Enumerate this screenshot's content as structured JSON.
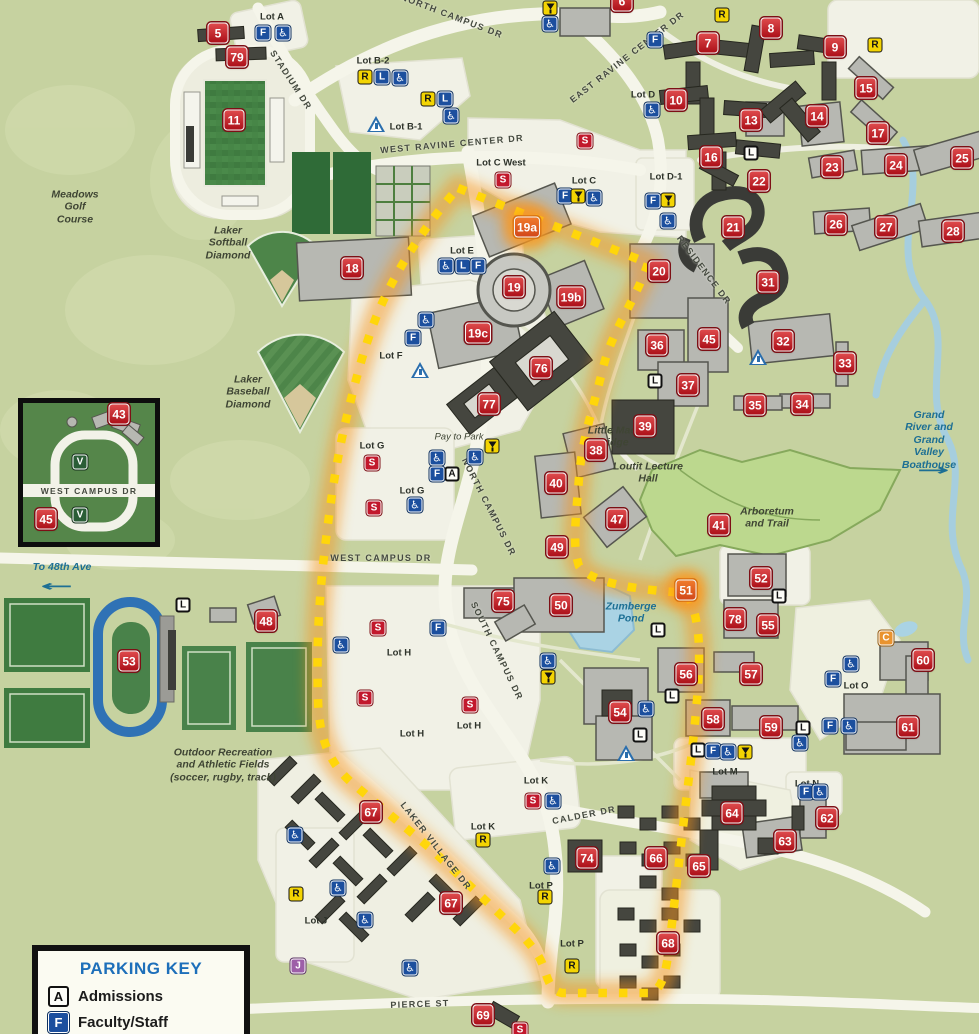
{
  "parking_key": {
    "title": "PARKING KEY",
    "entries": [
      {
        "code": "A",
        "label": "Admissions"
      },
      {
        "code": "F",
        "label": "Faculty/Staff"
      }
    ]
  },
  "colors": {
    "background": "#c6d2a0",
    "road": "#f5f5ea",
    "building_light": "#b7b8b2",
    "building_dark": "#45463f",
    "route_dots": "#ffd60a",
    "route_glow": "#f7941d",
    "badge_red": "#c01a22",
    "badge_blue": "#1c4f9e",
    "badge_yellow": "#f3d403",
    "water": "#a6cede",
    "field_green": "#47824a"
  },
  "road_labels": [
    {
      "text": "NORTH CAMPUS DR",
      "x": 452,
      "y": 16,
      "rot": 21,
      "size": 9
    },
    {
      "text": "EAST RAVINE CENTER DR",
      "x": 627,
      "y": 57,
      "rot": -38,
      "size": 9
    },
    {
      "text": "STADIUM DR",
      "x": 291,
      "y": 80,
      "rot": 57,
      "size": 9
    },
    {
      "text": "WEST RAVINE CENTER DR",
      "x": 452,
      "y": 144,
      "rot": -5,
      "size": 9
    },
    {
      "text": "RESIDENCE DR",
      "x": 704,
      "y": 270,
      "rot": 53,
      "size": 9
    },
    {
      "text": "NORTH CAMPUS DR",
      "x": 489,
      "y": 507,
      "rot": 63,
      "size": 9
    },
    {
      "text": "WEST CAMPUS DR",
      "x": 381,
      "y": 558,
      "rot": 0,
      "size": 9
    },
    {
      "text": "SOUTH CAMPUS DR",
      "x": 497,
      "y": 651,
      "rot": 64,
      "size": 9
    },
    {
      "text": "LAKER VILLAGE DR",
      "x": 436,
      "y": 846,
      "rot": 52,
      "size": 9
    },
    {
      "text": "CALDER  DR",
      "x": 584,
      "y": 815,
      "rot": -11,
      "size": 9
    },
    {
      "text": "PIERCE ST",
      "x": 420,
      "y": 1004,
      "rot": -2,
      "size": 9
    },
    {
      "text": "WEST CAMPUS DR",
      "x": 89,
      "y": 491,
      "rot": 0,
      "size": 8.5
    }
  ],
  "area_labels": [
    {
      "text": "Meadows\nGolf\nCourse",
      "x": 75,
      "y": 207,
      "style": "dark"
    },
    {
      "text": "Laker\nSoftball\nDiamond",
      "x": 228,
      "y": 243,
      "style": "dark"
    },
    {
      "text": "Laker\nBaseball\nDiamond",
      "x": 248,
      "y": 392,
      "style": "dark"
    },
    {
      "text": "Little Mac\nBridge",
      "x": 612,
      "y": 437,
      "style": "dark"
    },
    {
      "text": "Loutit Lecture\nHall",
      "x": 648,
      "y": 473,
      "style": "dark"
    },
    {
      "text": "Arboretum\nand Trail",
      "x": 767,
      "y": 518,
      "style": "dark"
    },
    {
      "text": "Zumberge\nPond",
      "x": 631,
      "y": 613,
      "style": "blue"
    },
    {
      "text": "Grand River and\nGrand Valley\nBoathouse",
      "x": 929,
      "y": 440,
      "style": "blue"
    },
    {
      "text": "To 48th Ave",
      "x": 62,
      "y": 567,
      "style": "blue"
    },
    {
      "text": "Outdoor Recreation\nand Athletic Fields\n(soccer, rugby, track)",
      "x": 223,
      "y": 765,
      "style": "dark"
    },
    {
      "text": "Pay to Park",
      "x": 459,
      "y": 437,
      "style": "dark small"
    }
  ],
  "arrows": [
    {
      "dir": "right",
      "glyph": "→",
      "x": 933,
      "y": 470
    },
    {
      "dir": "left",
      "glyph": "←",
      "x": 57,
      "y": 586
    }
  ],
  "lot_labels": [
    {
      "text": "Lot A",
      "x": 272,
      "y": 17
    },
    {
      "text": "Lot B-2",
      "x": 373,
      "y": 61
    },
    {
      "text": "Lot B-1",
      "x": 406,
      "y": 127
    },
    {
      "text": "Lot C West",
      "x": 501,
      "y": 163
    },
    {
      "text": "Lot C",
      "x": 584,
      "y": 181
    },
    {
      "text": "Lot D",
      "x": 643,
      "y": 95
    },
    {
      "text": "Lot D-1",
      "x": 666,
      "y": 177
    },
    {
      "text": "Lot E",
      "x": 462,
      "y": 251
    },
    {
      "text": "Lot F",
      "x": 391,
      "y": 356
    },
    {
      "text": "Lot G",
      "x": 372,
      "y": 446
    },
    {
      "text": "Lot G",
      "x": 412,
      "y": 491
    },
    {
      "text": "Lot H",
      "x": 399,
      "y": 653
    },
    {
      "text": "Lot H",
      "x": 412,
      "y": 734
    },
    {
      "text": "Lot H",
      "x": 469,
      "y": 726
    },
    {
      "text": "Lot J",
      "x": 316,
      "y": 921
    },
    {
      "text": "Lot K",
      "x": 536,
      "y": 781
    },
    {
      "text": "Lot K",
      "x": 483,
      "y": 827
    },
    {
      "text": "Lot M",
      "x": 725,
      "y": 772
    },
    {
      "text": "Lot N",
      "x": 807,
      "y": 784
    },
    {
      "text": "Lot O",
      "x": 856,
      "y": 686
    },
    {
      "text": "Lot P",
      "x": 541,
      "y": 886
    },
    {
      "text": "Lot P",
      "x": 572,
      "y": 944
    }
  ],
  "badges": {
    "numbers": [
      {
        "n": "5",
        "x": 218,
        "y": 33
      },
      {
        "n": "79",
        "x": 237,
        "y": 57
      },
      {
        "n": "11",
        "x": 234,
        "y": 120
      },
      {
        "n": "6",
        "x": 622,
        "y": 1
      },
      {
        "n": "7",
        "x": 708,
        "y": 43
      },
      {
        "n": "8",
        "x": 771,
        "y": 28
      },
      {
        "n": "9",
        "x": 835,
        "y": 47
      },
      {
        "n": "10",
        "x": 676,
        "y": 100
      },
      {
        "n": "13",
        "x": 751,
        "y": 120
      },
      {
        "n": "14",
        "x": 817,
        "y": 116
      },
      {
        "n": "15",
        "x": 866,
        "y": 88
      },
      {
        "n": "16",
        "x": 711,
        "y": 157
      },
      {
        "n": "17",
        "x": 878,
        "y": 133
      },
      {
        "n": "22",
        "x": 759,
        "y": 181
      },
      {
        "n": "23",
        "x": 832,
        "y": 167
      },
      {
        "n": "24",
        "x": 896,
        "y": 165
      },
      {
        "n": "25",
        "x": 962,
        "y": 158
      },
      {
        "n": "21",
        "x": 733,
        "y": 227
      },
      {
        "n": "26",
        "x": 836,
        "y": 224
      },
      {
        "n": "27",
        "x": 886,
        "y": 227
      },
      {
        "n": "28",
        "x": 953,
        "y": 231
      },
      {
        "n": "18",
        "x": 352,
        "y": 268
      },
      {
        "n": "19a",
        "x": 527,
        "y": 227,
        "glow": true
      },
      {
        "n": "19",
        "x": 514,
        "y": 287
      },
      {
        "n": "19b",
        "x": 571,
        "y": 297
      },
      {
        "n": "19c",
        "x": 478,
        "y": 333
      },
      {
        "n": "76",
        "x": 541,
        "y": 368
      },
      {
        "n": "77",
        "x": 489,
        "y": 404
      },
      {
        "n": "20",
        "x": 659,
        "y": 271
      },
      {
        "n": "31",
        "x": 768,
        "y": 282
      },
      {
        "n": "36",
        "x": 657,
        "y": 345
      },
      {
        "n": "45",
        "x": 709,
        "y": 339
      },
      {
        "n": "32",
        "x": 783,
        "y": 341
      },
      {
        "n": "33",
        "x": 845,
        "y": 363
      },
      {
        "n": "37",
        "x": 688,
        "y": 385
      },
      {
        "n": "35",
        "x": 755,
        "y": 405
      },
      {
        "n": "34",
        "x": 802,
        "y": 404
      },
      {
        "n": "39",
        "x": 645,
        "y": 426
      },
      {
        "n": "38",
        "x": 596,
        "y": 450
      },
      {
        "n": "40",
        "x": 556,
        "y": 483
      },
      {
        "n": "47",
        "x": 617,
        "y": 519
      },
      {
        "n": "49",
        "x": 557,
        "y": 547
      },
      {
        "n": "41",
        "x": 719,
        "y": 525
      },
      {
        "n": "52",
        "x": 761,
        "y": 578
      },
      {
        "n": "51",
        "x": 686,
        "y": 590,
        "glow": true
      },
      {
        "n": "75",
        "x": 503,
        "y": 601
      },
      {
        "n": "50",
        "x": 561,
        "y": 605
      },
      {
        "n": "78",
        "x": 735,
        "y": 619
      },
      {
        "n": "55",
        "x": 768,
        "y": 625
      },
      {
        "n": "60",
        "x": 923,
        "y": 660
      },
      {
        "n": "56",
        "x": 686,
        "y": 674
      },
      {
        "n": "57",
        "x": 751,
        "y": 674
      },
      {
        "n": "54",
        "x": 620,
        "y": 712
      },
      {
        "n": "58",
        "x": 713,
        "y": 719
      },
      {
        "n": "59",
        "x": 771,
        "y": 727
      },
      {
        "n": "61",
        "x": 908,
        "y": 727
      },
      {
        "n": "53",
        "x": 129,
        "y": 661
      },
      {
        "n": "48",
        "x": 266,
        "y": 621
      },
      {
        "n": "62",
        "x": 827,
        "y": 818
      },
      {
        "n": "63",
        "x": 785,
        "y": 841
      },
      {
        "n": "64",
        "x": 732,
        "y": 813
      },
      {
        "n": "66",
        "x": 656,
        "y": 858
      },
      {
        "n": "65",
        "x": 699,
        "y": 866
      },
      {
        "n": "67",
        "x": 371,
        "y": 812
      },
      {
        "n": "67",
        "x": 451,
        "y": 903
      },
      {
        "n": "74",
        "x": 587,
        "y": 858
      },
      {
        "n": "68",
        "x": 668,
        "y": 943
      },
      {
        "n": "69",
        "x": 483,
        "y": 1015
      },
      {
        "n": "43",
        "x": 119,
        "y": 414
      },
      {
        "n": "45",
        "x": 46,
        "y": 519
      }
    ],
    "letters": [
      {
        "t": "F",
        "x": 263,
        "y": 33
      },
      {
        "t": "X",
        "x": 283,
        "y": 33
      },
      {
        "t": "R",
        "x": 365,
        "y": 77
      },
      {
        "t": "L",
        "x": 382,
        "y": 77
      },
      {
        "t": "X",
        "x": 400,
        "y": 78
      },
      {
        "t": "R",
        "x": 428,
        "y": 99
      },
      {
        "t": "L",
        "x": 445,
        "y": 99
      },
      {
        "t": "X",
        "x": 451,
        "y": 116
      },
      {
        "t": "T",
        "x": 376,
        "y": 124
      },
      {
        "t": "V",
        "x": 550,
        "y": 8
      },
      {
        "t": "X",
        "x": 550,
        "y": 24
      },
      {
        "t": "R",
        "x": 722,
        "y": 15
      },
      {
        "t": "R",
        "x": 875,
        "y": 45
      },
      {
        "t": "F",
        "x": 655,
        "y": 40
      },
      {
        "t": "X",
        "x": 652,
        "y": 110
      },
      {
        "t": "S",
        "x": 503,
        "y": 180
      },
      {
        "t": "S",
        "x": 585,
        "y": 141
      },
      {
        "t": "F",
        "x": 565,
        "y": 196
      },
      {
        "t": "V",
        "x": 578,
        "y": 196
      },
      {
        "t": "X",
        "x": 594,
        "y": 198
      },
      {
        "t": "F",
        "x": 653,
        "y": 201
      },
      {
        "t": "V",
        "x": 668,
        "y": 200
      },
      {
        "t": "X",
        "x": 668,
        "y": 221
      },
      {
        "t": "X",
        "x": 446,
        "y": 266
      },
      {
        "t": "L",
        "x": 463,
        "y": 266
      },
      {
        "t": "F",
        "x": 478,
        "y": 266
      },
      {
        "t": "X",
        "x": 426,
        "y": 320
      },
      {
        "t": "F",
        "x": 413,
        "y": 338
      },
      {
        "t": "T",
        "x": 420,
        "y": 370
      },
      {
        "t": "LW",
        "x": 751,
        "y": 153
      },
      {
        "t": "LW",
        "x": 655,
        "y": 381
      },
      {
        "t": "LW",
        "x": 183,
        "y": 605
      },
      {
        "t": "T",
        "x": 758,
        "y": 357
      },
      {
        "t": "S",
        "x": 372,
        "y": 463
      },
      {
        "t": "S",
        "x": 374,
        "y": 508
      },
      {
        "t": "X",
        "x": 415,
        "y": 505
      },
      {
        "t": "X",
        "x": 437,
        "y": 458
      },
      {
        "t": "X",
        "x": 475,
        "y": 457
      },
      {
        "t": "V",
        "x": 492,
        "y": 446
      },
      {
        "t": "F",
        "x": 437,
        "y": 474
      },
      {
        "t": "A",
        "x": 452,
        "y": 474
      },
      {
        "t": "S",
        "x": 378,
        "y": 628
      },
      {
        "t": "F",
        "x": 438,
        "y": 628
      },
      {
        "t": "X",
        "x": 341,
        "y": 645
      },
      {
        "t": "S",
        "x": 365,
        "y": 698
      },
      {
        "t": "S",
        "x": 470,
        "y": 705
      },
      {
        "t": "X",
        "x": 548,
        "y": 661
      },
      {
        "t": "V",
        "x": 548,
        "y": 677
      },
      {
        "t": "LW",
        "x": 779,
        "y": 596
      },
      {
        "t": "LW",
        "x": 658,
        "y": 630
      },
      {
        "t": "X",
        "x": 646,
        "y": 709
      },
      {
        "t": "LW",
        "x": 640,
        "y": 735
      },
      {
        "t": "T",
        "x": 626,
        "y": 753
      },
      {
        "t": "LW",
        "x": 672,
        "y": 696
      },
      {
        "t": "LW",
        "x": 803,
        "y": 728
      },
      {
        "t": "X",
        "x": 800,
        "y": 743
      },
      {
        "t": "LW",
        "x": 698,
        "y": 750
      },
      {
        "t": "F",
        "x": 713,
        "y": 751
      },
      {
        "t": "X",
        "x": 728,
        "y": 752
      },
      {
        "t": "V",
        "x": 745,
        "y": 752
      },
      {
        "t": "X",
        "x": 851,
        "y": 664
      },
      {
        "t": "F",
        "x": 833,
        "y": 679
      },
      {
        "t": "F",
        "x": 830,
        "y": 726
      },
      {
        "t": "X",
        "x": 849,
        "y": 726
      },
      {
        "t": "C",
        "x": 886,
        "y": 638
      },
      {
        "t": "F",
        "x": 806,
        "y": 792
      },
      {
        "t": "X",
        "x": 820,
        "y": 792
      },
      {
        "t": "S",
        "x": 533,
        "y": 801
      },
      {
        "t": "X",
        "x": 553,
        "y": 801
      },
      {
        "t": "R",
        "x": 483,
        "y": 840
      },
      {
        "t": "X",
        "x": 552,
        "y": 866
      },
      {
        "t": "R",
        "x": 545,
        "y": 897
      },
      {
        "t": "R",
        "x": 572,
        "y": 966
      },
      {
        "t": "X",
        "x": 338,
        "y": 888
      },
      {
        "t": "X",
        "x": 365,
        "y": 920
      },
      {
        "t": "X",
        "x": 410,
        "y": 968
      },
      {
        "t": "X",
        "x": 295,
        "y": 835
      },
      {
        "t": "R",
        "x": 296,
        "y": 894
      },
      {
        "t": "J",
        "x": 298,
        "y": 966
      },
      {
        "t": "S",
        "x": 520,
        "y": 1030
      },
      {
        "t": "VG",
        "x": 80,
        "y": 462
      },
      {
        "t": "VG",
        "x": 80,
        "y": 515
      }
    ]
  }
}
